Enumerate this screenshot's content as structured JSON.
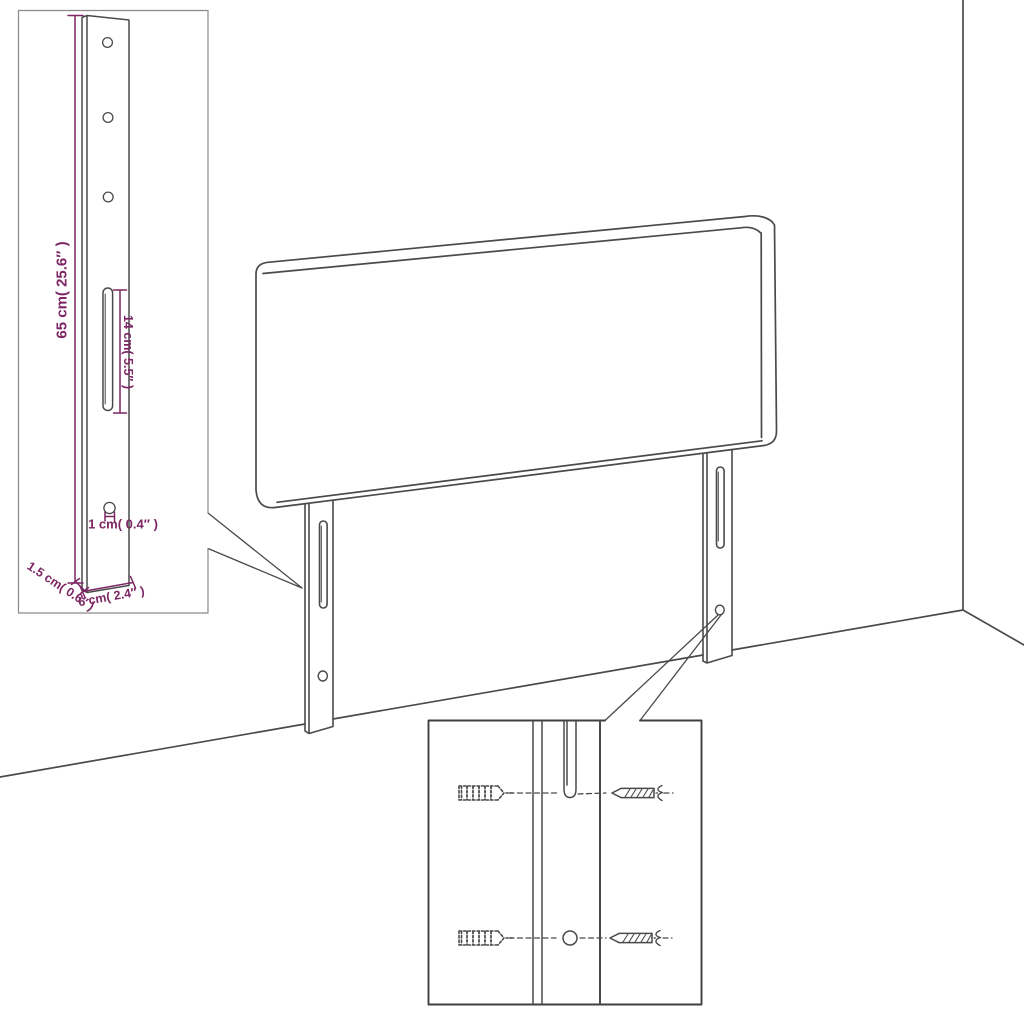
{
  "diagram": {
    "title": "headboard-mounting-dimension-diagram",
    "colors": {
      "line": "#4a4a4a",
      "dimension": "#7c2664",
      "inset_border_light": "#8a8a8a",
      "inset_border_dark": "#3f3f3f",
      "background": "#ffffff"
    },
    "bracket_inset": {
      "dim_height": "65 cm( 25.6″ )",
      "dim_slot": "14 cm( 5.5″ )",
      "dim_hole": "1 cm( 0.4″ )",
      "dim_thickness": "1.5 cm( 0.6″ )",
      "dim_width": "6 cm( 2.4″ )",
      "features": [
        "mounting-bracket",
        "screw-holes",
        "adjustment-slot"
      ]
    },
    "hardware_inset": {
      "features": [
        "wall-plug",
        "screw",
        "adjustment-slot",
        "screw-hole"
      ]
    }
  }
}
